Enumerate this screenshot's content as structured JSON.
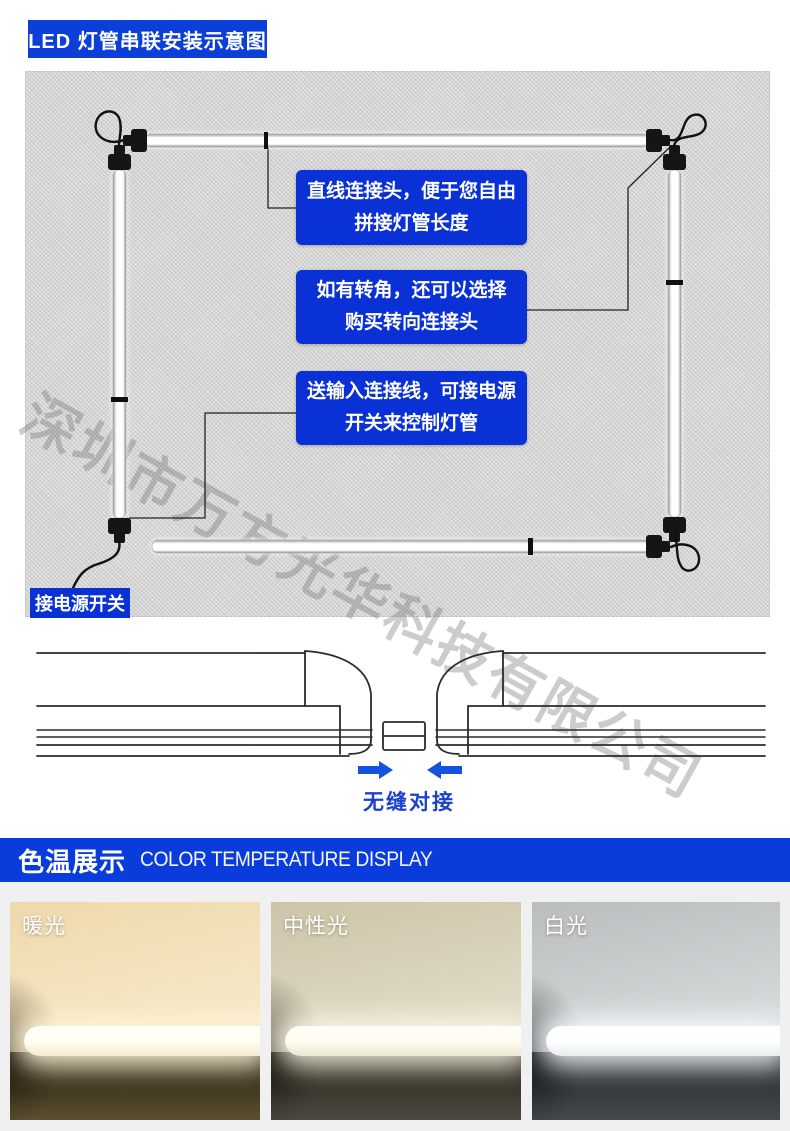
{
  "title_badge": "LED 灯管串联安装示意图",
  "watermark": "深圳市万方光华科技有限公司",
  "diagram": {
    "callouts": [
      {
        "line1": "直线连接头，便于您自由",
        "line2": "拼接灯管长度"
      },
      {
        "line1": "如有转角，还可以选择",
        "line2": "购买转向连接头"
      },
      {
        "line1": "送输入连接线，可接电源",
        "line2": "开关来控制灯管"
      }
    ],
    "power_switch_label": "接电源开关"
  },
  "seam": {
    "caption": "无缝对接"
  },
  "color_temp": {
    "title_cn": "色温展示",
    "title_en": "COLOR TEMPERATURE DISPLAY",
    "panels": [
      {
        "label": "暖光"
      },
      {
        "label": "中性光"
      },
      {
        "label": "白光"
      }
    ]
  },
  "colors": {
    "banner_blue": "#0a3cdb",
    "callout_blue": "#0a31d6",
    "arrow_blue": "#1253e2",
    "caption_blue": "#1c41ce",
    "diagram_panel_gray": "#d4d4d4",
    "lower_section_gray": "#f0f0f0"
  }
}
